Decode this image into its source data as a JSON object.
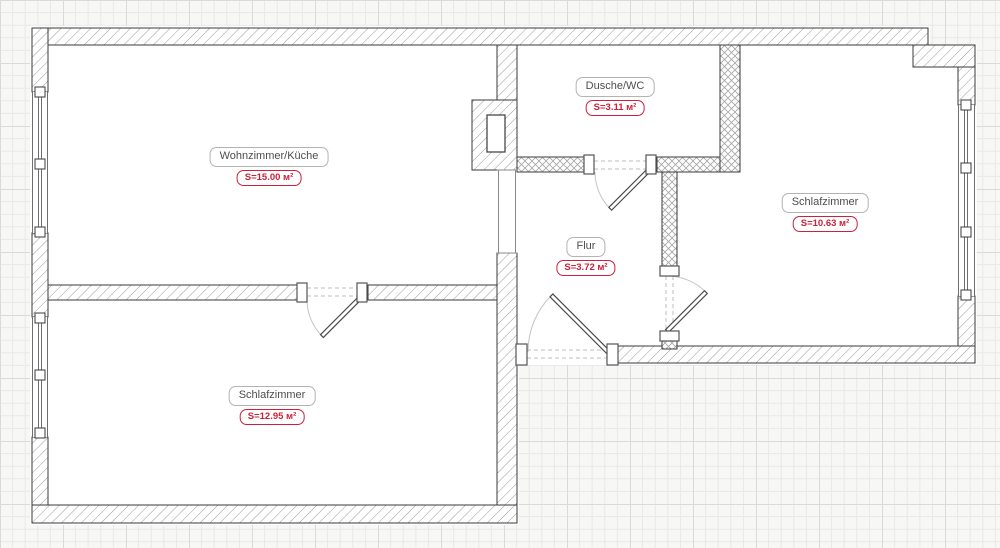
{
  "plan": {
    "type": "apartment-floor-plan",
    "rooms": [
      {
        "id": "wohnzimmer-kueche",
        "name": "Wohnzimmer/Küche",
        "area": "S=15.00 м²"
      },
      {
        "id": "dusche-wc",
        "name": "Dusche/WC",
        "area": "S=3.11 м²"
      },
      {
        "id": "schlafzimmer-r",
        "name": "Schlafzimmer",
        "area": "S=10.63 м²"
      },
      {
        "id": "flur",
        "name": "Flur",
        "area": "S=3.72 м²"
      },
      {
        "id": "schlafzimmer-b",
        "name": "Schlafzimmer",
        "area": "S=12.95 м²"
      }
    ],
    "colors": {
      "area_accent": "#cc2139",
      "label_border": "#b3b3b3",
      "label_text": "#4d4d4d",
      "wall_line": "#3a3a3a",
      "hatch": "#9a9a9a",
      "grid_minor": "#e9e9e9",
      "grid_major": "#d9d9d9"
    }
  }
}
